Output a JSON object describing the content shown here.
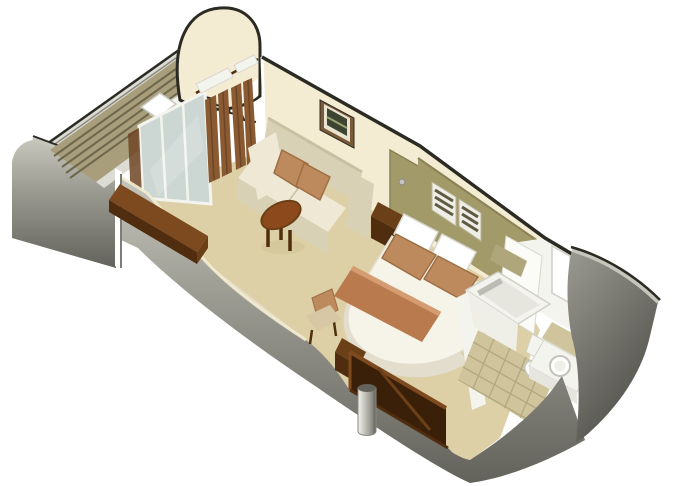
{
  "scene": {
    "type": "isometric-cutaway-floor-plan",
    "subject": "cruise-ship-stateroom-with-veranda",
    "background": "#ffffff"
  },
  "rooms": [
    {
      "id": "veranda",
      "desc": "balcony deck with lounger"
    },
    {
      "id": "sitting-area",
      "desc": "sofa, wall art, coffee table, desk"
    },
    {
      "id": "bedroom",
      "desc": "double bed with headboard panel"
    },
    {
      "id": "bathroom",
      "desc": "bathtub, toilet, sink vanity"
    },
    {
      "id": "entry",
      "desc": "corridor with wardrobe and door"
    }
  ],
  "furniture": [
    "deck-lounger",
    "sliding-glass-door",
    "curtains",
    "sofa",
    "throw-pillows",
    "wall-art",
    "coffee-table",
    "writing-desk",
    "desk-chair",
    "closet-door",
    "headboard-panel",
    "louver-vents",
    "double-bed",
    "bed-pillows",
    "throw-blanket",
    "nightstand",
    "wardrobe",
    "support-column",
    "bathtub",
    "toilet",
    "sink-vanity",
    "entry-door"
  ],
  "colors": {
    "outline": "#2b2b24",
    "white": "#ffffff",
    "hull_light": "#c6c6bd",
    "hull_mid": "#9a9a91",
    "hull_dark": "#63635c",
    "hull_darker": "#50504a",
    "cream": "#f3ecd2",
    "cream_shadow": "#e0d6b4",
    "floor": "#ddd0a6",
    "floor_shadow": "#cdbf93",
    "deck": "#a89e7b",
    "deck_slat": "#6f674c",
    "rail_light": "#dcdcd4",
    "rail_line": "#8a8a80",
    "glass": "#ccd6d3",
    "glass_frame": "#f4f4ef",
    "curtain": "#8a5a33",
    "curtain_dark": "#6e4524",
    "sofa": "#eee8d4",
    "sofa_shadow": "#d9d1b6",
    "sofa_dark": "#c9c0a4",
    "pillow": "#bc8a5c",
    "pillow_dark": "#9e6e44",
    "table_wood": "#8c4a1c",
    "desk_wood": "#7d4a1f",
    "wood_mid": "#6b3f17",
    "wood_dark": "#4f2d0e",
    "wood_side": "#5e3513",
    "wardrobe_int": "#3a2008",
    "olive": "#a39a69",
    "olive_dark": "#8a8156",
    "vent_slat": "#5f5a42",
    "vent_frame": "#eeeee6",
    "bed_white": "#f6f3e9",
    "bed_shadow": "#e2ddcd",
    "blanket": "#b97a4e",
    "blanket_light": "#d59c71",
    "tile": "#cfc49c",
    "tile_grout": "#b3a87e",
    "fixture": "#f4f4ee",
    "fixture_bright": "#fbfbf7",
    "fixture_shadow": "#d8d8d0",
    "fixture_deep": "#bcbcb4",
    "tub_front": "#efefe8",
    "tub_basin": "#e6e6de",
    "art": "#3d4432",
    "art_light": "#9aa36e",
    "frame_brown": "#7b5a3a",
    "frame_mat": "#e9e3d1",
    "knob": "#c4c4c4",
    "khaki": "#b0a67c",
    "chair_seat": "#d7c7a4"
  }
}
